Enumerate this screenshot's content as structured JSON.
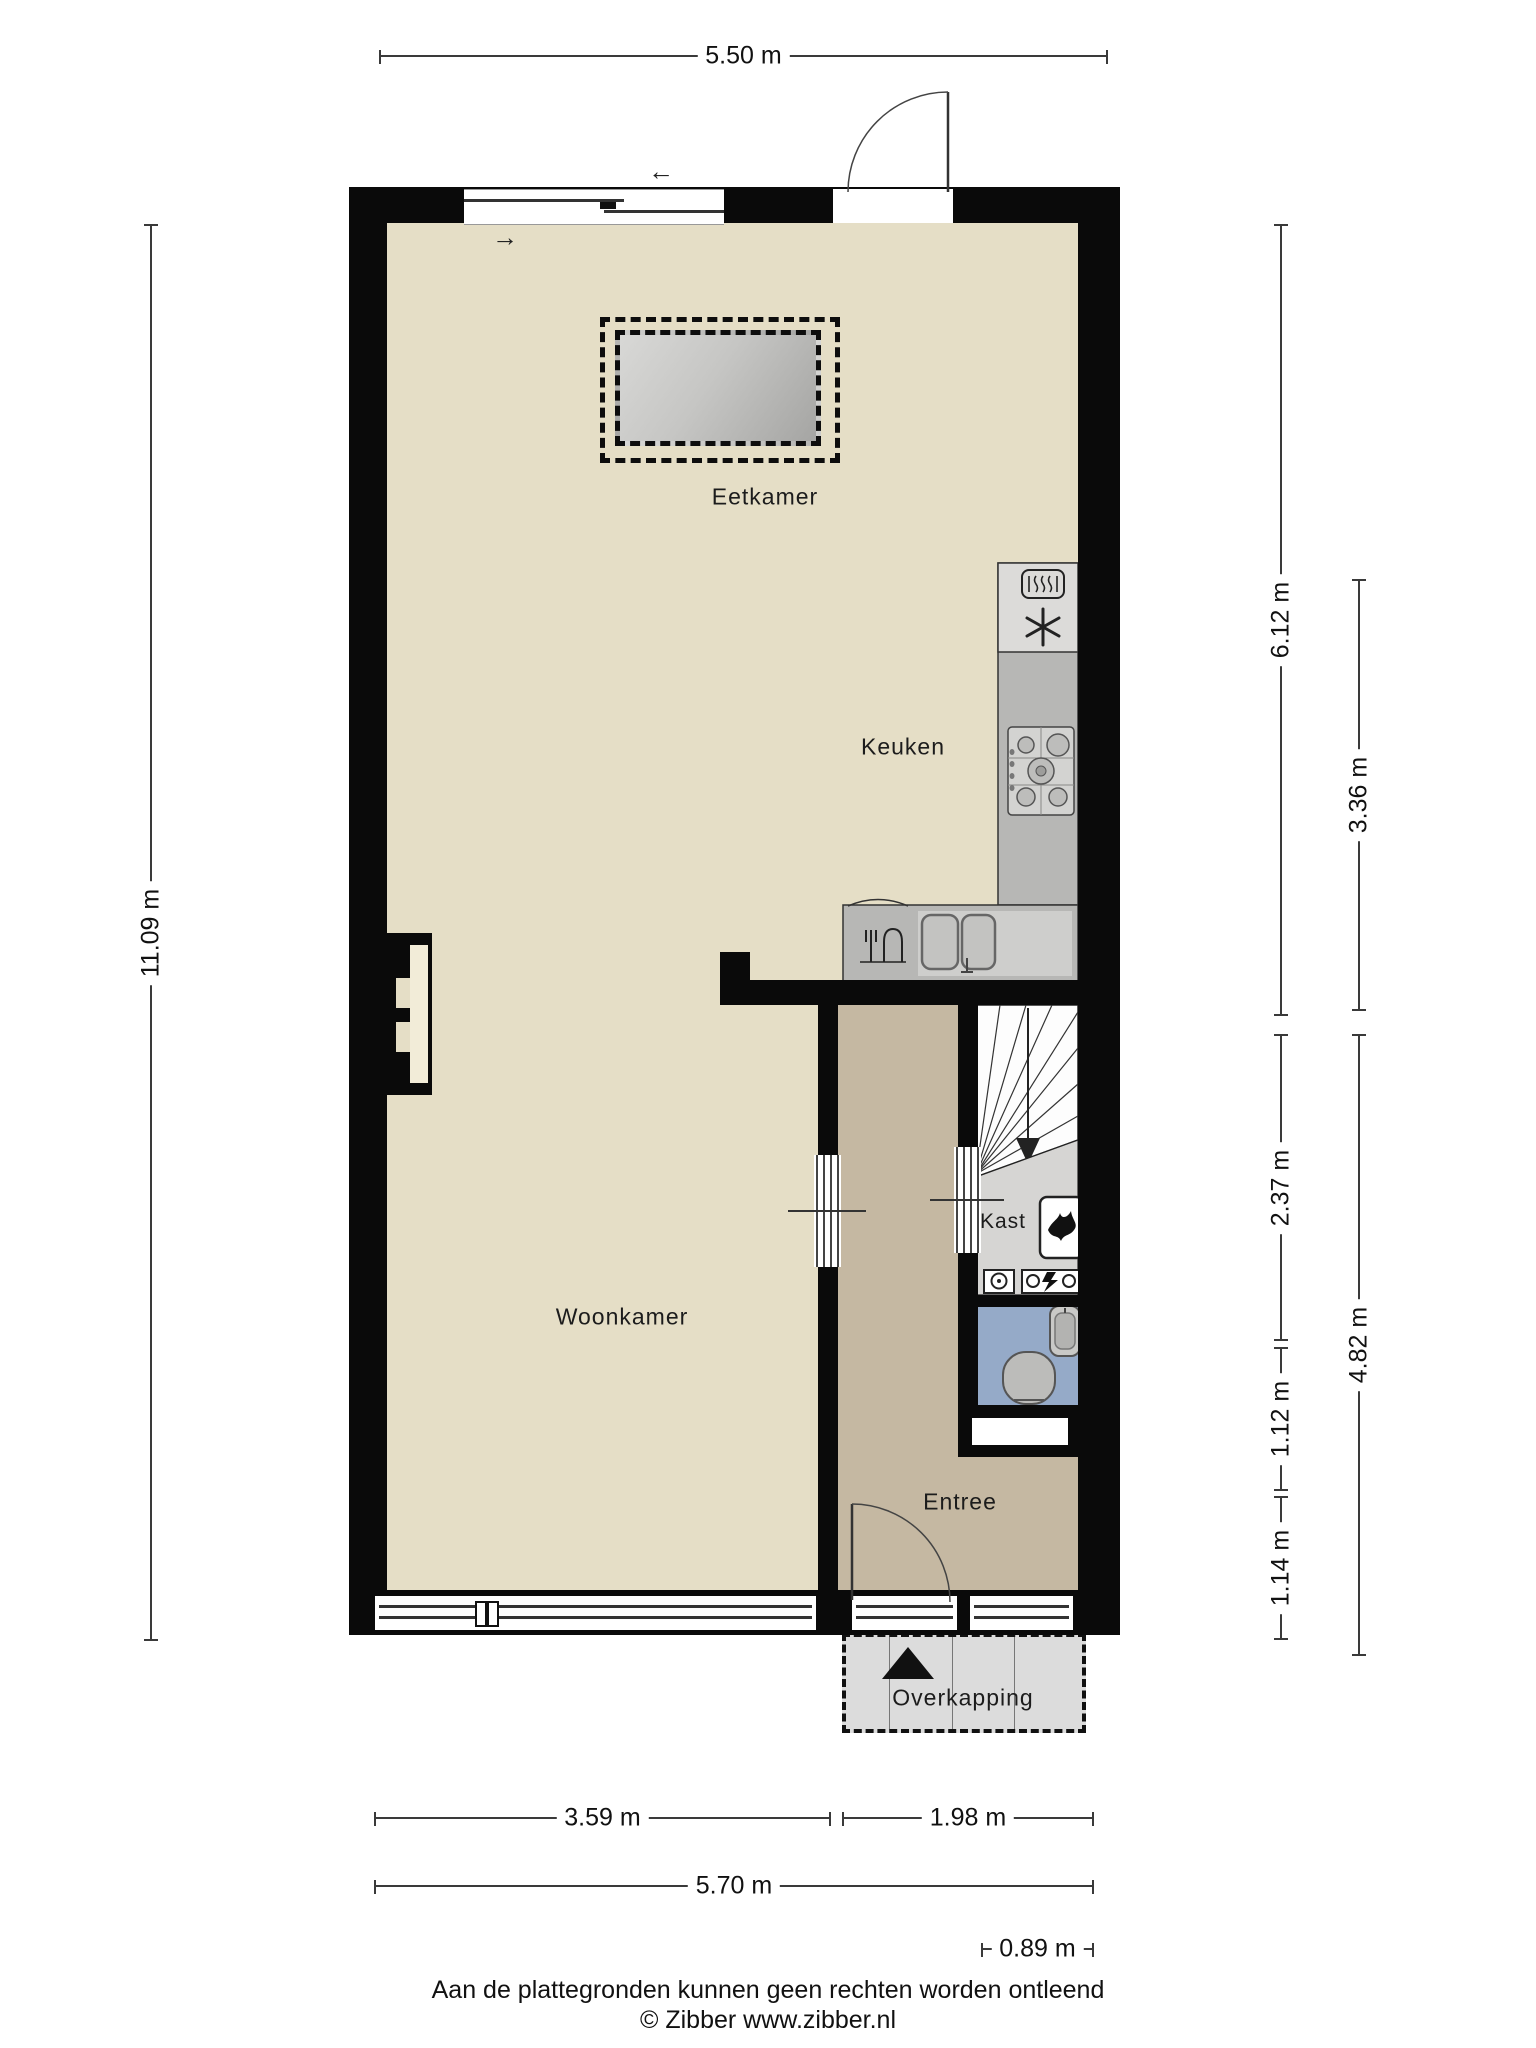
{
  "title": "Begane grond plattegrond",
  "rooms": {
    "eetkamer": "Eetkamer",
    "keuken": "Keuken",
    "woonkamer": "Woonkamer",
    "kast": "Kast",
    "entree": "Entree",
    "overkapping": "Overkapping"
  },
  "dimensions": {
    "top": "5.50 m",
    "left": "11.09 m",
    "right_col1": [
      "6.12 m",
      "2.37 m",
      "1.12 m",
      "1.14 m"
    ],
    "right_col2": [
      "3.36 m",
      "4.82 m"
    ],
    "bottom": [
      "3.59 m",
      "1.98 m",
      "5.70 m",
      "0.89 m"
    ]
  },
  "icons": {
    "slide_left_arrow": "←",
    "slide_right_arrow": "→"
  },
  "footer": {
    "line1": "Aan de plattegronden kunnen geen rechten worden ontleend",
    "line2": "© Zibber www.zibber.nl"
  },
  "colors": {
    "wall": "#0a0a0a",
    "floor_main": "#e5dec6",
    "floor_hall": "#c5b8a2",
    "floor_toilet": "#95aac8",
    "closet_gray": "#d6d5d3",
    "counter_gray": "#b7b7b5",
    "appliance_gray": "#dcdbd9",
    "overkapping_gray": "#dcdcdc"
  }
}
